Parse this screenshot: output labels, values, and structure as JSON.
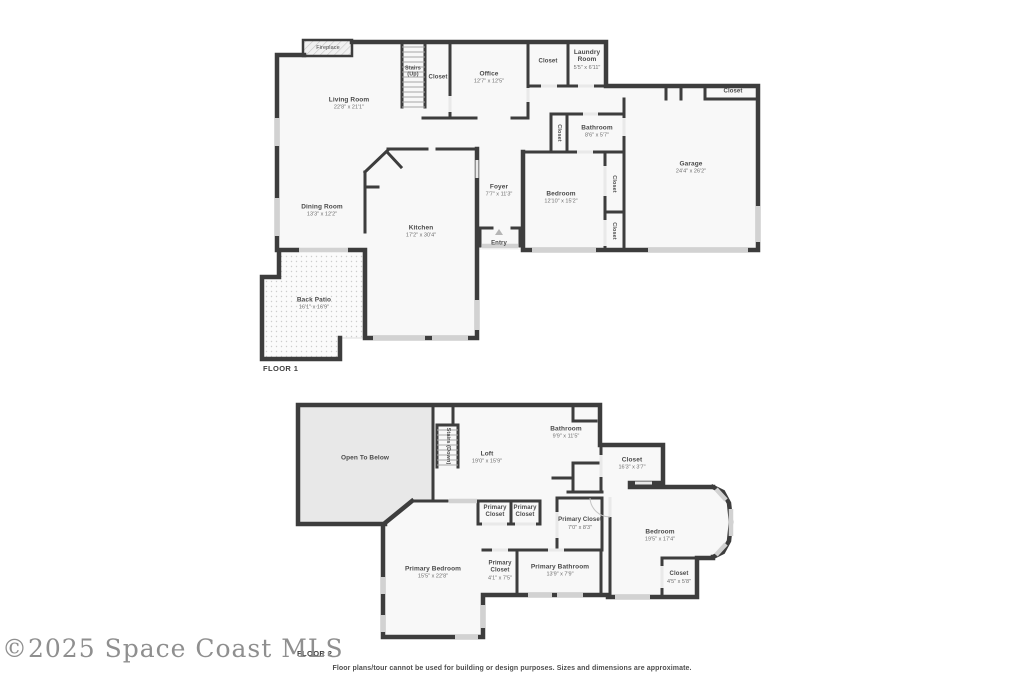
{
  "watermark": "©2025 Space Coast MLS",
  "footer": {
    "disclaimer": "Floor plans/tour cannot be used for building or design purposes. Sizes and dimensions are approximate."
  },
  "colors": {
    "wall": "#3d3d3d",
    "room": "#f8f8f8",
    "open-below": "#e8e8e8",
    "window": "#d2d2d2",
    "label": "#4a4a4a",
    "dims": "#6e6e6e"
  },
  "floor1": {
    "label": "FLOOR 1",
    "fireplace": {
      "name": "Fireplace"
    },
    "living_room": {
      "name": "Living Room",
      "dims": "22'8\" x 21'1\""
    },
    "stairs_up": {
      "name": "Stairs (Up)"
    },
    "stairs_closet": {
      "name": "Closet"
    },
    "office": {
      "name": "Office",
      "dims": "12'7\" x 12'5\""
    },
    "hall_closet": {
      "name": "Closet"
    },
    "laundry": {
      "name": "Laundry Room",
      "dims": "5'5\" x 6'11\""
    },
    "garage_closet": {
      "name": "Closet"
    },
    "bath_closet": {
      "name": "Closet"
    },
    "bathroom": {
      "name": "Bathroom",
      "dims": "8'6\" x 5'7\""
    },
    "bedroom_closet_1": {
      "name": "Closet"
    },
    "bedroom_closet_2": {
      "name": "Closet"
    },
    "bedroom": {
      "name": "Bedroom",
      "dims": "12'10\" x 15'2\""
    },
    "garage": {
      "name": "Garage",
      "dims": "24'4\" x 26'2\""
    },
    "foyer": {
      "name": "Foyer",
      "dims": "7'7\" x 11'3\""
    },
    "entry": {
      "name": "Entry"
    },
    "kitchen": {
      "name": "Kitchen",
      "dims": "17'2\" x 30'4\""
    },
    "dining_room": {
      "name": "Dining Room",
      "dims": "13'3\" x 12'2\""
    },
    "back_patio": {
      "name": "Back Patio",
      "dims": "16'1\" x 16'9\""
    }
  },
  "floor2": {
    "label": "FLOOR 2",
    "open_to_below": {
      "name": "Open To Below"
    },
    "stairs_down": {
      "name": "Stairs (Down)"
    },
    "loft": {
      "name": "Loft",
      "dims": "19'0\" x 15'9\""
    },
    "bathroom": {
      "name": "Bathroom",
      "dims": "9'9\" x 11'5\""
    },
    "hall_closet": {
      "name": "Closet",
      "dims": "16'3\" x 3'7\""
    },
    "primary_closet_a": {
      "name": "Primary Closet"
    },
    "primary_closet_b": {
      "name": "Primary Closet"
    },
    "primary_closet_c": {
      "name": "Primary Closet",
      "dims": "7'0\" x 8'3\""
    },
    "bedroom": {
      "name": "Bedroom",
      "dims": "19'5\" x 17'4\""
    },
    "bedroom_closet": {
      "name": "Closet",
      "dims": "4'5\" x 5'8\""
    },
    "primary_bedroom": {
      "name": "Primary Bedroom",
      "dims": "15'5\" x 22'8\""
    },
    "primary_closet_d": {
      "name": "Primary Closet",
      "dims": "4'1\" x 7'5\""
    },
    "primary_bathroom": {
      "name": "Primary Bathroom",
      "dims": "13'9\" x 7'9\""
    }
  }
}
